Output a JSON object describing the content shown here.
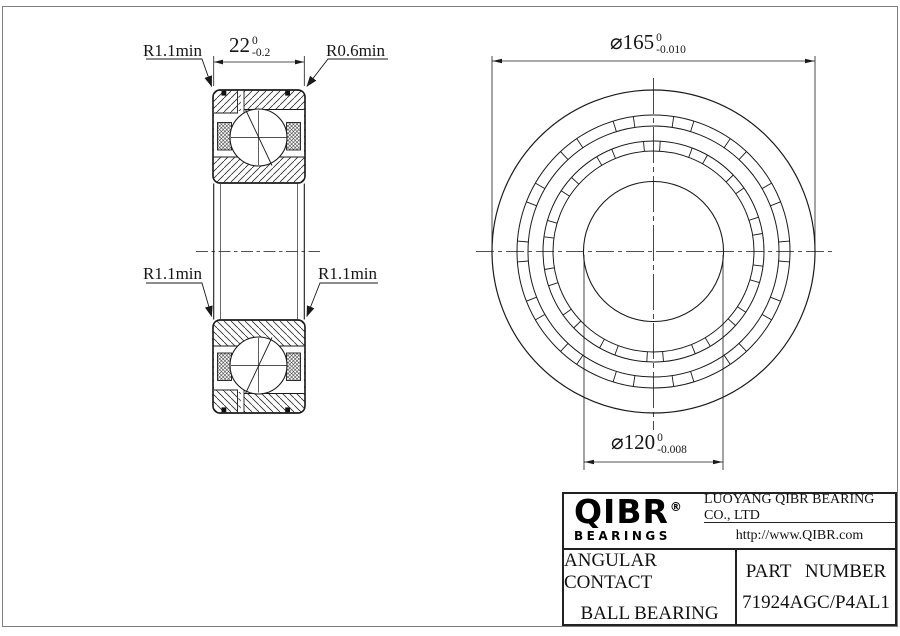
{
  "drawing": {
    "dim_width": {
      "value": "22",
      "tol_upper": "0",
      "tol_lower": "-0.2"
    },
    "dim_od": {
      "value": "⌀165",
      "tol_upper": "0",
      "tol_lower": "-0.010"
    },
    "dim_bore": {
      "value": "⌀120",
      "tol_upper": "0",
      "tol_lower": "-0.008"
    },
    "radius_top_left": "R1.1min",
    "radius_top_right": "R0.6min",
    "radius_mid_left": "R1.1min",
    "radius_mid_right": "R1.1min"
  },
  "title_block": {
    "logo_text": "QIBR",
    "logo_registered": "®",
    "logo_sub": "BEARINGS",
    "company": "LUOYANG QIBR BEARING CO., LTD",
    "website": "http://www.QIBR.com",
    "product_line1": "ANGULAR CONTACT",
    "product_line2": "BALL BEARING",
    "part_label": "PART NUMBER",
    "part_number": "71924AGC/P4AL1"
  },
  "colors": {
    "line": "#1a1a1a",
    "frame": "#7e7e7e"
  }
}
